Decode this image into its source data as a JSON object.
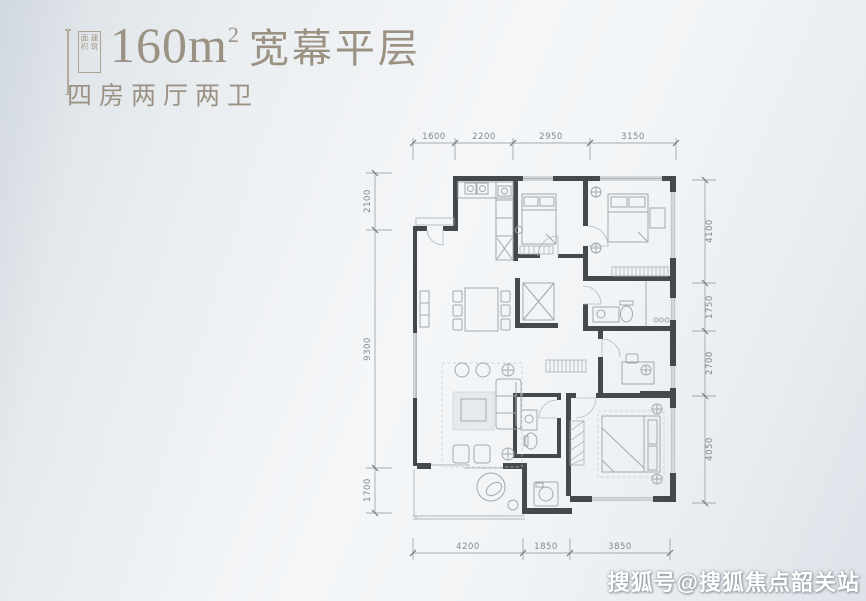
{
  "header": {
    "badge_col_right": "建筑",
    "badge_col_left": "面积",
    "area_value": "160m",
    "area_sup": "2",
    "title": "宽幕平层",
    "subtitle": "四房两厅两卫"
  },
  "plan": {
    "dims": {
      "top": [
        "1600",
        "2200",
        "2950",
        "3150"
      ],
      "left": [
        "2100",
        "9300",
        "1700"
      ],
      "right": [
        "4100",
        "1750",
        "2700",
        "4050"
      ],
      "bottom": [
        "4200",
        "1850",
        "3850"
      ]
    }
  },
  "watermark": "搜狐号@搜狐焦点韶关站",
  "colors": {
    "title_text": "#9c9284",
    "dimension_text": "#81888f",
    "wall": "#45484c",
    "furniture_line": "#a2a9ae",
    "background_light": "#f4f6f8",
    "background_dark": "#dce2e8",
    "watermark_text": "#ffffff"
  }
}
